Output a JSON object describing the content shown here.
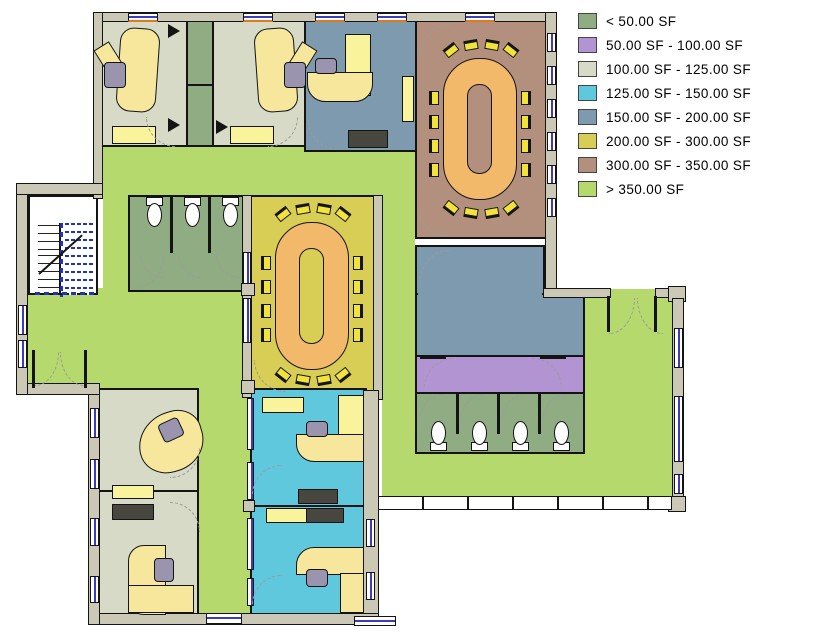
{
  "title": "Color-fill area plan",
  "colors": {
    "wall": "#cbc9b6",
    "floor_lt50": "#8fac83",
    "floor_50_100": "#b294d2",
    "floor_100_125": "#d8dac8",
    "floor_125_150": "#5fc8dc",
    "floor_150_200": "#7e9aae",
    "floor_200_300": "#d8ce55",
    "floor_300_350": "#b3907e",
    "floor_gt350": "#b5d96d",
    "desk": "#f6e79d",
    "cabinet": "#f9f39b",
    "chair": "#f1e23c",
    "table": "#f3b96b",
    "credenza": "#474740",
    "office_chair": "#9a94ae",
    "glass": "#3c3cc0",
    "accent": "#e07a1f",
    "arc": "#9b9b9b",
    "stair": "#2233bb"
  },
  "legend": {
    "items": [
      {
        "label": "< 50.00 SF",
        "color": "#8fac83"
      },
      {
        "label": "50.00 SF - 100.00 SF",
        "color": "#b294d2"
      },
      {
        "label": "100.00 SF - 125.00 SF",
        "color": "#d8dac8"
      },
      {
        "label": "125.00 SF - 150.00 SF",
        "color": "#5fc8dc"
      },
      {
        "label": "150.00 SF - 200.00 SF",
        "color": "#7e9aae"
      },
      {
        "label": "200.00 SF - 300.00 SF",
        "color": "#d8ce55"
      },
      {
        "label": "300.00 SF - 350.00 SF",
        "color": "#b3907e"
      },
      {
        "label": "> 350.00 SF",
        "color": "#b5d96d"
      }
    ]
  },
  "rooms": [
    {
      "name": "office-northwest-1",
      "category": "100.00 SF - 125.00 SF"
    },
    {
      "name": "closet-northwest",
      "category": "< 50.00 SF"
    },
    {
      "name": "office-northwest-2",
      "category": "100.00 SF - 125.00 SF"
    },
    {
      "name": "office-north",
      "category": "150.00 SF - 200.00 SF"
    },
    {
      "name": "conference-northeast",
      "category": "300.00 SF - 350.00 SF"
    },
    {
      "name": "restroom-west",
      "category": "< 50.00 SF"
    },
    {
      "name": "conference-center",
      "category": "200.00 SF - 300.00 SF"
    },
    {
      "name": "room-east",
      "category": "150.00 SF - 200.00 SF"
    },
    {
      "name": "vestibule-east",
      "category": "50.00 SF - 100.00 SF"
    },
    {
      "name": "restroom-east",
      "category": "< 50.00 SF"
    },
    {
      "name": "office-southwest-1",
      "category": "100.00 SF - 125.00 SF"
    },
    {
      "name": "office-southwest-2",
      "category": "100.00 SF - 125.00 SF"
    },
    {
      "name": "office-south-1",
      "category": "125.00 SF - 150.00 SF"
    },
    {
      "name": "office-south-2",
      "category": "125.00 SF - 150.00 SF"
    },
    {
      "name": "circulation-open-area",
      "category": "> 350.00 SF"
    }
  ]
}
